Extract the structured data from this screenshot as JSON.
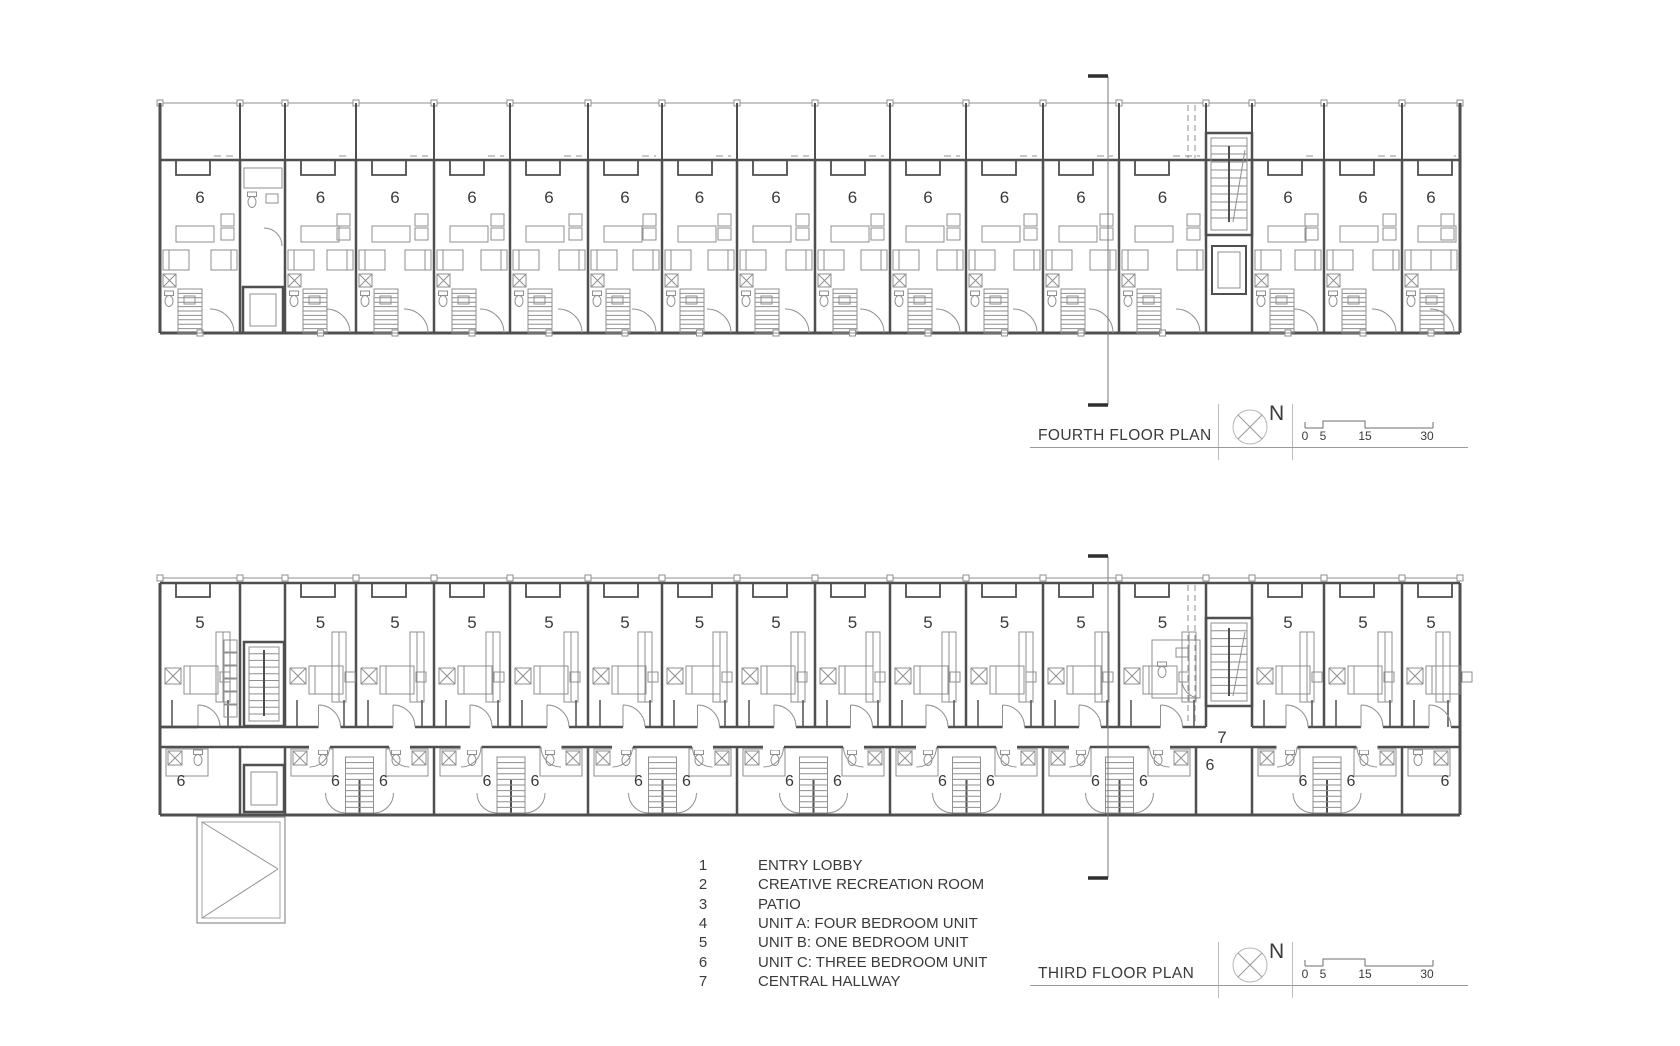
{
  "colors": {
    "wall": "#4f4f4f",
    "line": "#8f8f8f",
    "light": "#b5b5b5",
    "text": "#3a3a3a",
    "mark": "#2f2f2f"
  },
  "plans": [
    {
      "title": "FOURTH FLOOR PLAN",
      "north_label": "N",
      "scale_ticks": [
        "0",
        "5",
        "15",
        "30"
      ],
      "unit_labels": [
        "6",
        "6",
        "6",
        "6",
        "6",
        "6",
        "6",
        "6",
        "6",
        "6",
        "6",
        "6",
        "6",
        "6",
        "6",
        "6"
      ]
    },
    {
      "title": "THIRD FLOOR PLAN",
      "north_label": "N",
      "scale_ticks": [
        "0",
        "5",
        "15",
        "30"
      ],
      "upper_unit_labels": [
        "5",
        "5",
        "5",
        "5",
        "5",
        "5",
        "5",
        "5",
        "5",
        "5",
        "5",
        "5",
        "5",
        "5",
        "5",
        "5"
      ],
      "lower_unit_labels": [
        "6",
        "6",
        "6",
        "6",
        "6",
        "6",
        "6",
        "6",
        "6",
        "6",
        "6",
        "6",
        "6",
        "6",
        "6",
        "6",
        "6"
      ],
      "hallway_label": "7"
    }
  ],
  "legend": {
    "items": [
      {
        "number": "1",
        "label": "ENTRY LOBBY"
      },
      {
        "number": "2",
        "label": "CREATIVE RECREATION ROOM"
      },
      {
        "number": "3",
        "label": "PATIO"
      },
      {
        "number": "4",
        "label": "UNIT A: FOUR BEDROOM UNIT"
      },
      {
        "number": "5",
        "label": "UNIT B: ONE BEDROOM UNIT"
      },
      {
        "number": "6",
        "label": "UNIT C: THREE BEDROOM UNIT"
      },
      {
        "number": "7",
        "label": "CENTRAL HALLWAY"
      }
    ]
  }
}
